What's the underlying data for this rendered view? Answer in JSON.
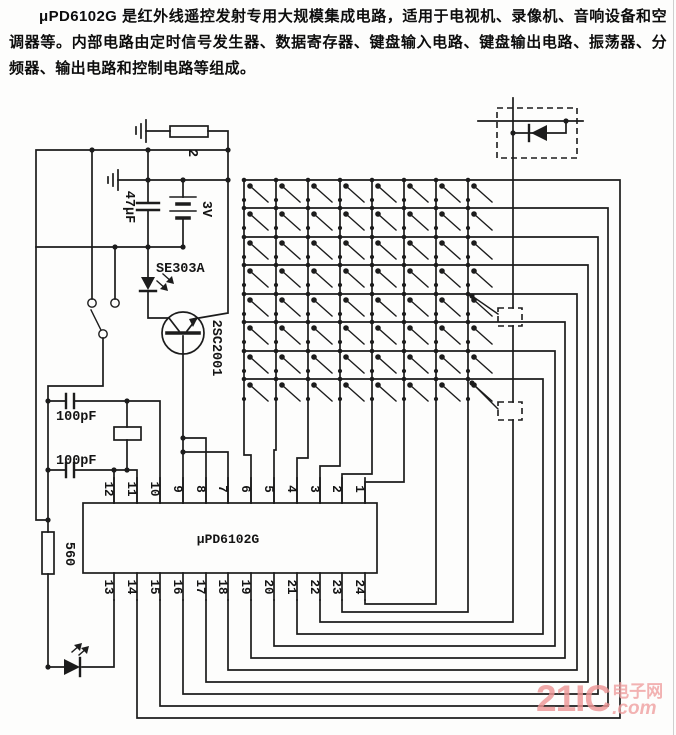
{
  "description": "μPD6102G 是红外线遥控发射专用大规模集成电路，适用于电视机、录像机、音响设备和空调器等。内部电路由定时信号发生器、数据寄存器、键盘输入电路、键盘输出电路、振荡器、分频器、输出电路和控制电路等组成。",
  "components": {
    "resistor_top": "2",
    "capacitor_47uf": "47μF",
    "battery": "3V",
    "ir_led_model": "SE303A",
    "transistor": "2SC2001",
    "capacitor_100pf_a": "100pF",
    "capacitor_100pf_b": "100pF",
    "resistor_560": "560"
  },
  "ic": {
    "label": "μPD6102G",
    "top_pins": [
      "12",
      "11",
      "10",
      "9",
      "8",
      "7",
      "6",
      "5",
      "4",
      "3",
      "2",
      "1"
    ],
    "bottom_pins": [
      "13",
      "14",
      "15",
      "16",
      "17",
      "18",
      "19",
      "20",
      "21",
      "22",
      "23",
      "24"
    ]
  },
  "matrix": {
    "rows": 8,
    "cols": 8
  },
  "watermark": {
    "brand": "21IC",
    "site": "电子网",
    "tld": ".com"
  },
  "colors": {
    "wire": "#1c1c1c",
    "background": "#fdfdfc",
    "watermark_pink": "#ee9696"
  }
}
